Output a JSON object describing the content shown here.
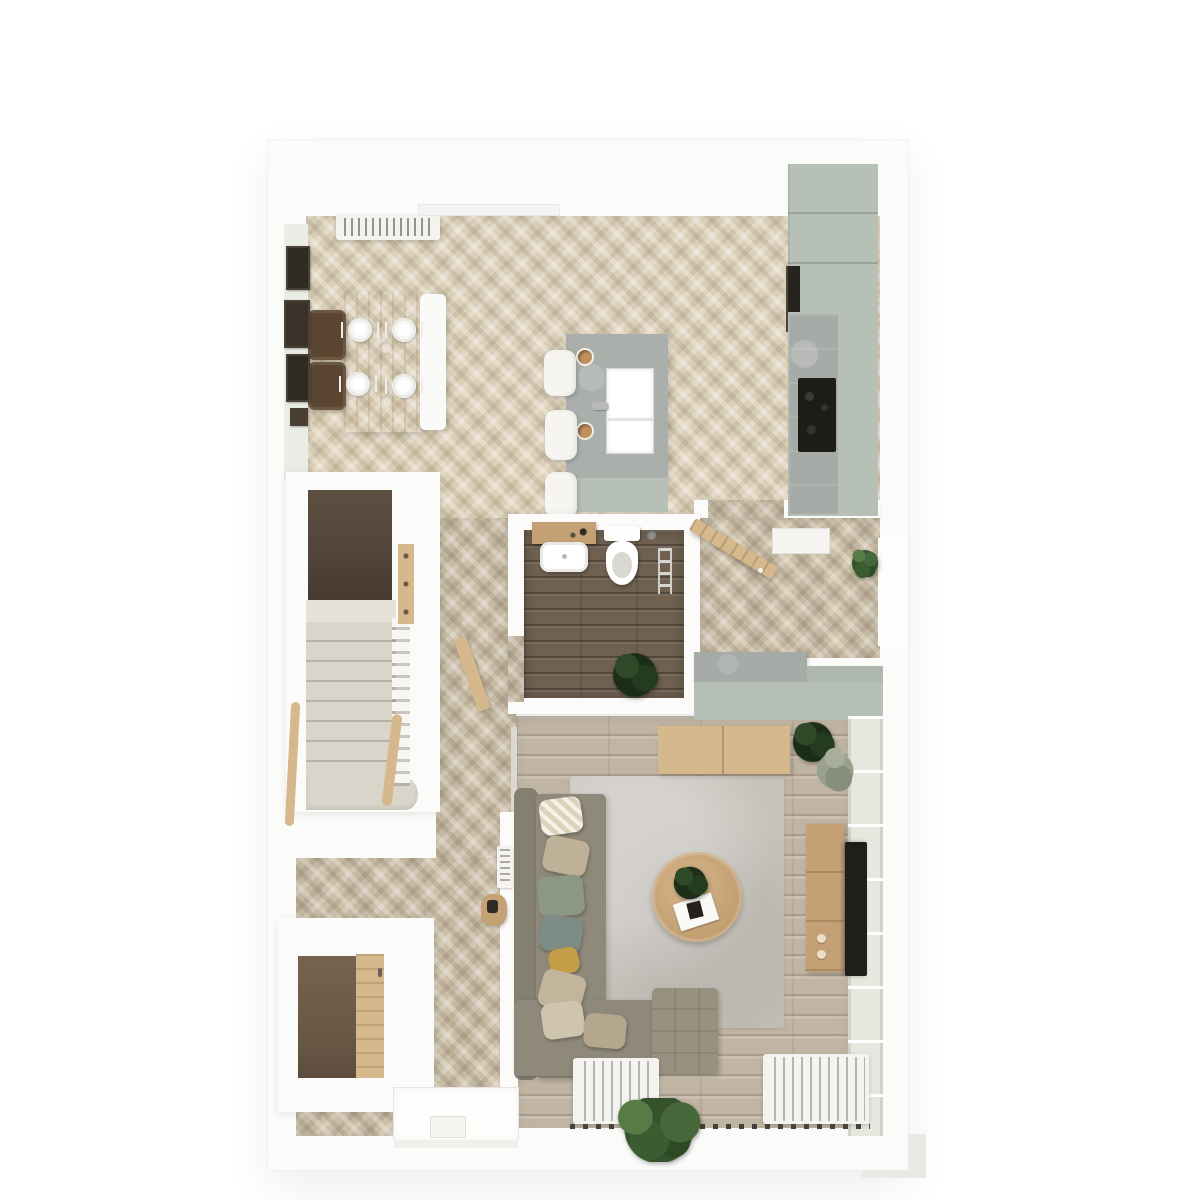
{
  "scene": {
    "type": "3d-floorplan-top-view",
    "rooms": [
      {
        "id": "kitchen-dining",
        "floor": "light oak herringbone",
        "items": [
          "dining table with four place settings and two serving bowls",
          "two dark timber dining chairs",
          "white dining bench",
          "wall radiator under window",
          "four picture frames on wall",
          "kitchen island with inset sink, tap and two cups",
          "three white bar stools",
          "tall sage cabinets with built-in oven",
          "grey worktop with black hob"
        ]
      },
      {
        "id": "stair-hall",
        "floor": "light oak herringbone",
        "items": [
          "staircase with landing and curved bottom step",
          "white spindle balustrade",
          "timber handrails",
          "timber coat rack with hooks",
          "under-stairs cupboard with timber door",
          "small radiator",
          "timber side stool",
          "rear door with doormat"
        ]
      },
      {
        "id": "wc",
        "floor": "dark timber boards",
        "items": [
          "timber vanity shelf with wash basin",
          "toilet with cistern",
          "toilet brush",
          "chrome towel rail",
          "potted plant",
          "door ajar"
        ]
      },
      {
        "id": "entry-hall",
        "floor": "light oak herringbone",
        "items": [
          "front door standing open",
          "entry mat",
          "porch recess with plant",
          "sage storage bench with grey seat"
        ]
      },
      {
        "id": "living-room",
        "floor": "grey-washed timber boards",
        "items": [
          "L-shaped sofa with eight scatter cushions",
          "tufted ottoman",
          "round timber coffee table with plant and book",
          "large grey rug",
          "timber sideboard",
          "timber media console with knobs",
          "wall-mounted TV",
          "glazed window wall",
          "two slatted radiators",
          "window sill",
          "corner houseplants",
          "patio slab outside"
        ]
      }
    ]
  },
  "colors": {
    "wall": "#fbfbfa",
    "floor_oak": "#dbcfb8",
    "floor_taupe": "#ccbfa8",
    "floor_living": "#c0b4a3",
    "floor_wc": "#6f6050",
    "cabinet_sage": "#b7c0b7",
    "counter_grey": "#a7aba7",
    "island_grey": "#abafab",
    "hob_black": "#1d1c19",
    "stool_white": "#f6f5f2",
    "wood_light": "#d5b88c",
    "wood_mid": "#c3a175",
    "sofa_grey": "#8f897b",
    "rug_grey": "#c7c3bc",
    "cushion_sage": "#8d9884",
    "cushion_mustard": "#c59c47",
    "plant_green": "#35522c",
    "plant_light": "#587a44",
    "tv_black": "#201e1b",
    "stair_tread": "#d9d5cb",
    "void_dark": "#52443a",
    "radiator": "#f4f3f0"
  }
}
